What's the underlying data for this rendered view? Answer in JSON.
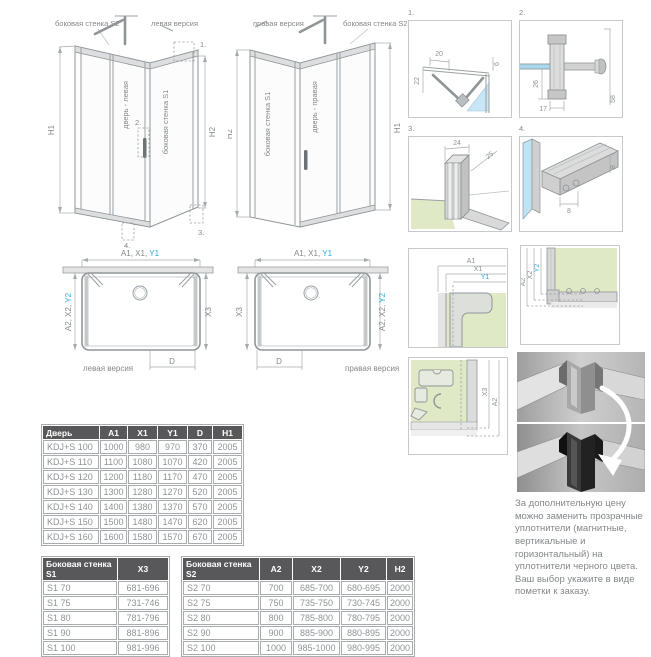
{
  "colors": {
    "accent_blue": "#29a9e0",
    "label_gray": "#84888b",
    "table_header_bg": "#58585b",
    "tray_green": "#e0e9c6",
    "glass_blue": "#aadcf2"
  },
  "iso_left": {
    "wall_s2": "боковая стенка S2",
    "version": "левая версия",
    "door": "дверь - левая",
    "wall_s1": "боковая стенка S1",
    "dim_left": "H1",
    "dim_right": "H2",
    "callout_1": "1.",
    "callout_2": "2.",
    "callout_3": "3.",
    "callout_4": "4."
  },
  "iso_right": {
    "version": "правая версия",
    "wall_s2": "боковая стенка S2",
    "wall_s1": "боковая стенка S1",
    "door": "дверь - правая",
    "dim_left": "H2",
    "dim_right": "H1"
  },
  "plan_left": {
    "top_prefix": "A1, X1, ",
    "top_blue": "Y1",
    "left_prefix": "A2, X2, ",
    "left_blue": "Y2",
    "right": "X3",
    "door": "D",
    "caption": "левая версия"
  },
  "plan_right": {
    "top_prefix": "A1, X1, ",
    "top_blue": "Y1",
    "left": "X3",
    "right_prefix": "A2, X2, ",
    "right_blue": "Y2",
    "door": "D",
    "caption": "правая версия"
  },
  "details": {
    "d1": {
      "num": "1.",
      "dim_a": "20",
      "dim_b": "6",
      "dim_c": "22"
    },
    "d2": {
      "num": "2.",
      "dim_a": "26",
      "dim_b": "17",
      "dim_c": "58"
    },
    "d3": {
      "num": "3.",
      "dim_a": "24",
      "dim_b": "25"
    },
    "d4": {
      "num": "4.",
      "dim_a": "8",
      "dim_b": "8"
    },
    "d5": {
      "dim_a": "A1",
      "dim_b": "X1",
      "dim_c": "Y1"
    },
    "d6": {
      "dim_a": "A2",
      "dim_b": "X2",
      "dim_c": "Y2"
    },
    "d7": {
      "dim_a": "X3",
      "dim_b": "A2"
    }
  },
  "door_table": {
    "header": [
      "Дверь",
      "A1",
      "X1",
      "Y1",
      "D",
      "H1"
    ],
    "rows": [
      [
        "KDJ+S 100",
        "1000",
        "980",
        "970",
        "370",
        "2005"
      ],
      [
        "KDJ+S 110",
        "1100",
        "1080",
        "1070",
        "420",
        "2005"
      ],
      [
        "KDJ+S 120",
        "1200",
        "1180",
        "1170",
        "470",
        "2005"
      ],
      [
        "KDJ+S 130",
        "1300",
        "1280",
        "1270",
        "520",
        "2005"
      ],
      [
        "KDJ+S 140",
        "1400",
        "1380",
        "1370",
        "570",
        "2005"
      ],
      [
        "KDJ+S 150",
        "1500",
        "1480",
        "1470",
        "620",
        "2005"
      ],
      [
        "KDJ+S 160",
        "1600",
        "1580",
        "1570",
        "670",
        "2005"
      ]
    ]
  },
  "s1_table": {
    "header": [
      "Боковая стенка S1",
      "X3"
    ],
    "rows": [
      [
        "S1 70",
        "681-696"
      ],
      [
        "S1 75",
        "731-746"
      ],
      [
        "S1 80",
        "781-796"
      ],
      [
        "S1 90",
        "881-896"
      ],
      [
        "S1 100",
        "981-996"
      ]
    ]
  },
  "s2_table": {
    "header": [
      "Боковая стенка S2",
      "A2",
      "X2",
      "Y2",
      "H2"
    ],
    "rows": [
      [
        "S2 70",
        "700",
        "685-700",
        "680-695",
        "2000"
      ],
      [
        "S2 75",
        "750",
        "735-750",
        "730-745",
        "2000"
      ],
      [
        "S2 80",
        "800",
        "785-800",
        "780-795",
        "2000"
      ],
      [
        "S2 90",
        "900",
        "885-900",
        "880-895",
        "2000"
      ],
      [
        "S2 100",
        "1000",
        "985-1000",
        "980-995",
        "2000"
      ]
    ]
  },
  "note": "За дополнительную цену можно заменить прозрачные уплотнители (магнитные, вертикальные и горизонтальный) на уплотнители черного цвета. Ваш выбор укажите в виде пометки к заказу."
}
